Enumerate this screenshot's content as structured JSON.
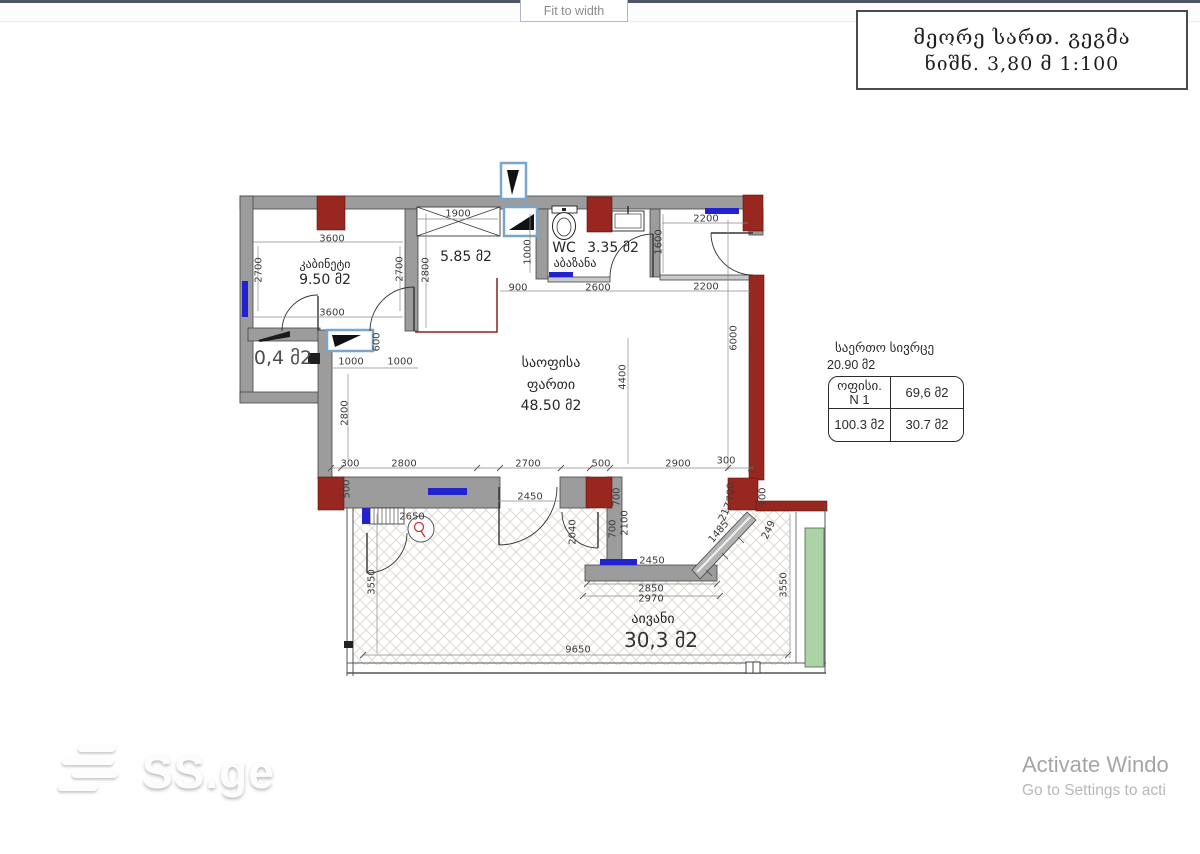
{
  "toolbar": {
    "fit_to_width_label": "Fit to width"
  },
  "title_box": {
    "line1": "მეორე სართ. გეგმა",
    "line2": "ნიშნ. 3,80 მ 1:100"
  },
  "plan": {
    "rooms": {
      "cabinet": {
        "name": "კაბინეტი",
        "area": "9.50 მ2"
      },
      "room_585": {
        "area": "5.85 მ2"
      },
      "wc": {
        "label": "WC",
        "area": "3.35 მ2",
        "name": "აბაზანა"
      },
      "office": {
        "line1": "საოფისა",
        "line2": "ფართი",
        "area": "48.50 მ2"
      },
      "niche": {
        "area": "0,4 მ2"
      },
      "balcony": {
        "name": "აივანი",
        "area": "30,3 მ2"
      }
    },
    "dims": [
      "3600",
      "2700",
      "2700",
      "3600",
      "1900",
      "2800",
      "1000",
      "900",
      "2600",
      "2200",
      "1600",
      "2200",
      "6000",
      "4400",
      "600",
      "1000",
      "1000",
      "2800",
      "300",
      "2800",
      "2700",
      "500",
      "2900",
      "300",
      "500",
      "2450",
      "2650",
      "700",
      "2100",
      "700",
      "2040",
      "700",
      "700",
      "217",
      "1485",
      "249",
      "2450",
      "2850",
      "2970",
      "3550",
      "3550",
      "9650"
    ]
  },
  "area_table": {
    "title": "საერთო სივრცე",
    "total": "20.90 მ2",
    "office_label": "ოფისი.",
    "office_number": "N 1",
    "office_area": "69,6 მ2",
    "total_area": "100.3 მ2",
    "balcony_area": "30.7 მ2"
  },
  "watermark": {
    "brand": "SS.ge"
  },
  "os_notice": {
    "line1": "Activate Windo",
    "line2": "Go to Settings to acti"
  },
  "colors": {
    "wall_red": "#97271f",
    "window_blue": "#2222cf",
    "balcony_green": "#abd3a5",
    "wall_gray": "#9c9c9c"
  }
}
